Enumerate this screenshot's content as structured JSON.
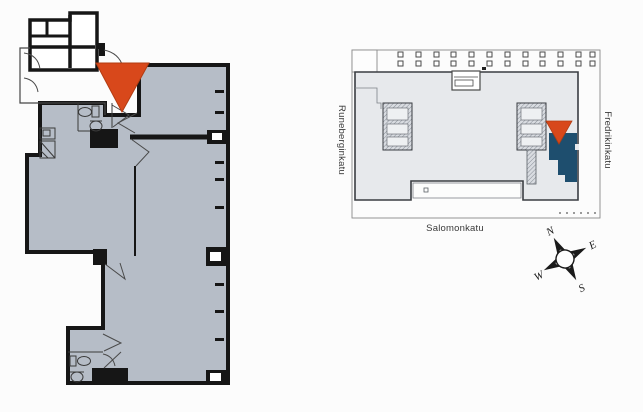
{
  "canvas": {
    "width": 643,
    "height": 412,
    "background": "#fcfcfc"
  },
  "apartment_plan": {
    "title": "apartment-floor-plan",
    "floor_fill": "#b6bdc7",
    "wall_color": "#161616",
    "marker_color": "#d8481b"
  },
  "site_plan": {
    "title": "site-plan-overview",
    "building_fill": "#e7e9ec",
    "outline_color": "#3a3d42",
    "highlight_fill": "#1e4e6e",
    "marker_color": "#d8481b",
    "streets": {
      "left": "Runeberginkatu",
      "right": "Fredrikinkatu",
      "bottom": "Salomonkatu"
    }
  },
  "compass": {
    "north": "N",
    "east": "E",
    "south": "S",
    "west": "W",
    "rotation_deg": -28
  }
}
